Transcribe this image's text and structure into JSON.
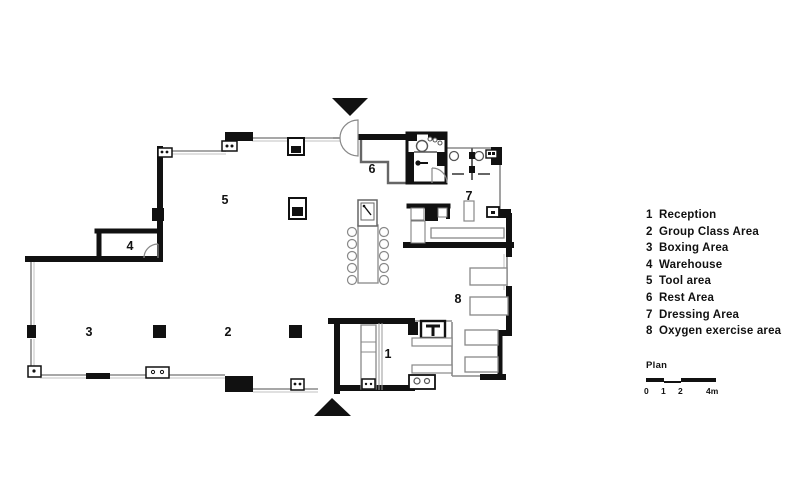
{
  "legend": {
    "items": [
      {
        "num": "1",
        "label": "Reception"
      },
      {
        "num": "2",
        "label": "Group Class Area"
      },
      {
        "num": "3",
        "label": "Boxing Area"
      },
      {
        "num": "4",
        "label": "Warehouse"
      },
      {
        "num": "5",
        "label": "Tool area"
      },
      {
        "num": "6",
        "label": "Rest Area"
      },
      {
        "num": "7",
        "label": "Dressing Area"
      },
      {
        "num": "8",
        "label": "Oxygen exercise area"
      }
    ]
  },
  "scale": {
    "title": "Plan",
    "ticks": [
      "0",
      "1",
      "2",
      "4m"
    ]
  },
  "colors": {
    "wall": "#111111",
    "thin_line": "#8a8a8a",
    "background": "#ffffff"
  }
}
